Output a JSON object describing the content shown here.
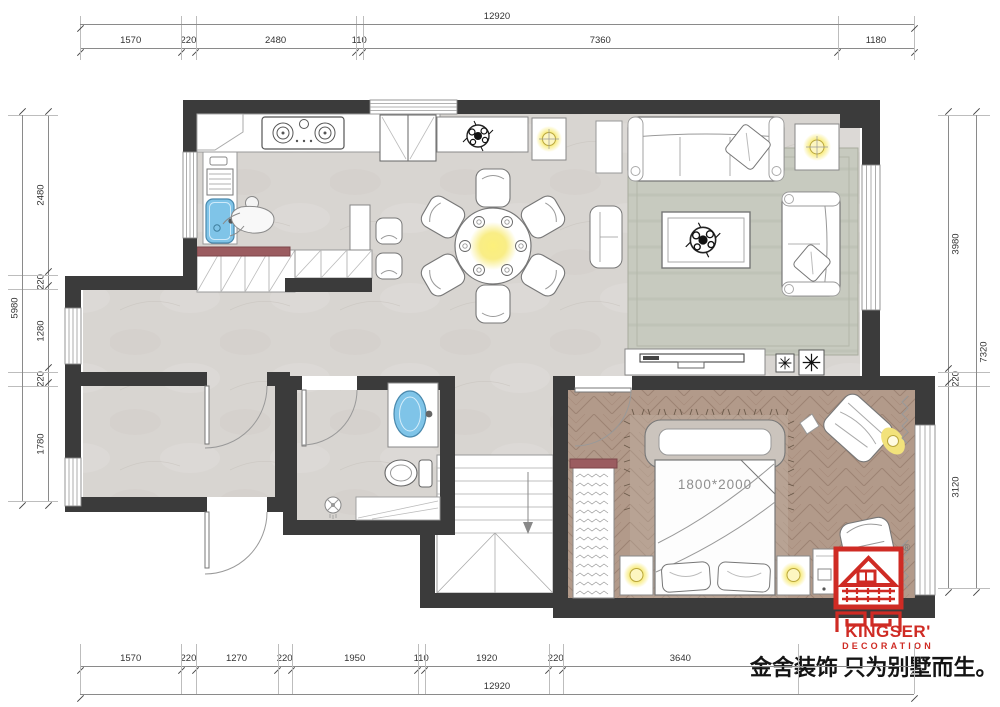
{
  "plan": {
    "bed_label": "1800*2000"
  },
  "dimensions": {
    "top": {
      "total": "12920",
      "segments": [
        "1570",
        "220",
        "2480",
        "110",
        "7360",
        "1180"
      ]
    },
    "bottom": {
      "total": "12920",
      "segments": [
        "1570",
        "220",
        "1270",
        "220",
        "1950",
        "110",
        "1920",
        "220",
        "3640"
      ]
    },
    "left": {
      "total": "5980",
      "segments": [
        "2480",
        "220",
        "1280",
        "220",
        "1780"
      ]
    },
    "right": {
      "total": "7320",
      "segments": [
        "3980",
        "220",
        "3120"
      ]
    }
  },
  "branding": {
    "logo_name": "KINGSER'",
    "logo_subtitle": "DECORATION",
    "registered_mark": "®",
    "slogan": "金舍装饰 只为别墅而生。"
  },
  "colors": {
    "wall": "#3b3b3b",
    "floor_tile": "#d8d5d1",
    "floor_wood": "#b29a8a",
    "rug": "#c7cabf",
    "accent_red": "#9b5c60",
    "lamp_yellow": "#f8eb79",
    "sink_blue": "#7fc4e8",
    "logo_red": "#cf2b24"
  }
}
